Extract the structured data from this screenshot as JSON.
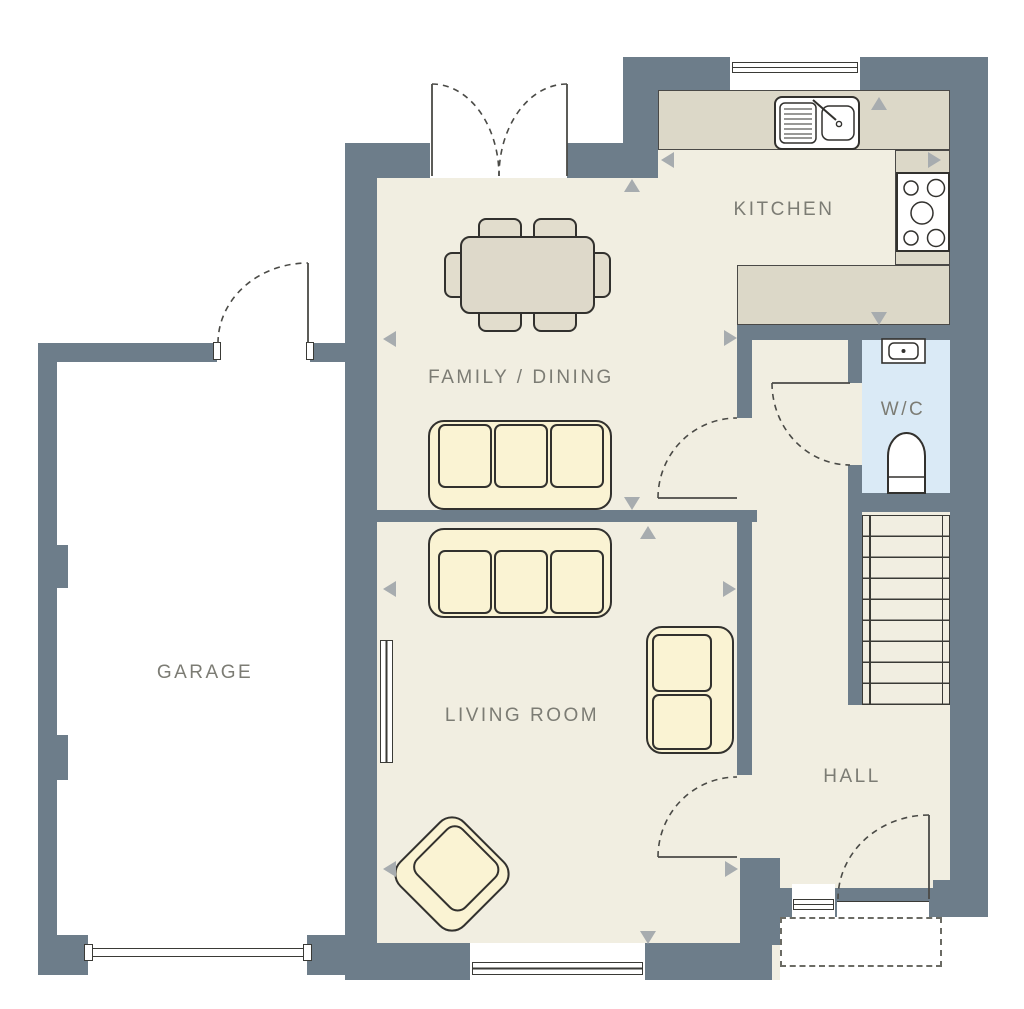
{
  "title": "Ground floor plan",
  "rooms": [
    {
      "id": "kitchen",
      "label": "KITCHEN"
    },
    {
      "id": "family-dining",
      "label": "FAMILY / DINING"
    },
    {
      "id": "wc",
      "label": "W/C"
    },
    {
      "id": "garage",
      "label": "GARAGE"
    },
    {
      "id": "living-room",
      "label": "LIVING ROOM"
    },
    {
      "id": "hall",
      "label": "HALL"
    }
  ],
  "colors": {
    "wall": "#6d7d8a",
    "floor": "#f1eee1",
    "counter": "#dcd8c8",
    "furniture": "#faf3d3",
    "table": "#ded9ca",
    "wc_floor": "#daeaf6",
    "outline": "#32312e",
    "door_line": "#4a4a46",
    "label_text": "#7c7c74",
    "marker": "#a7acaf"
  },
  "fixtures": [
    "sink",
    "hob",
    "toilet",
    "basin",
    "stairs",
    "radiator",
    "dining-table",
    "dining-chairs",
    "sofa-3-seat",
    "sofa-2-seat",
    "armchair",
    "french-doors",
    "garage-door",
    "front-door",
    "porch-canopy"
  ]
}
